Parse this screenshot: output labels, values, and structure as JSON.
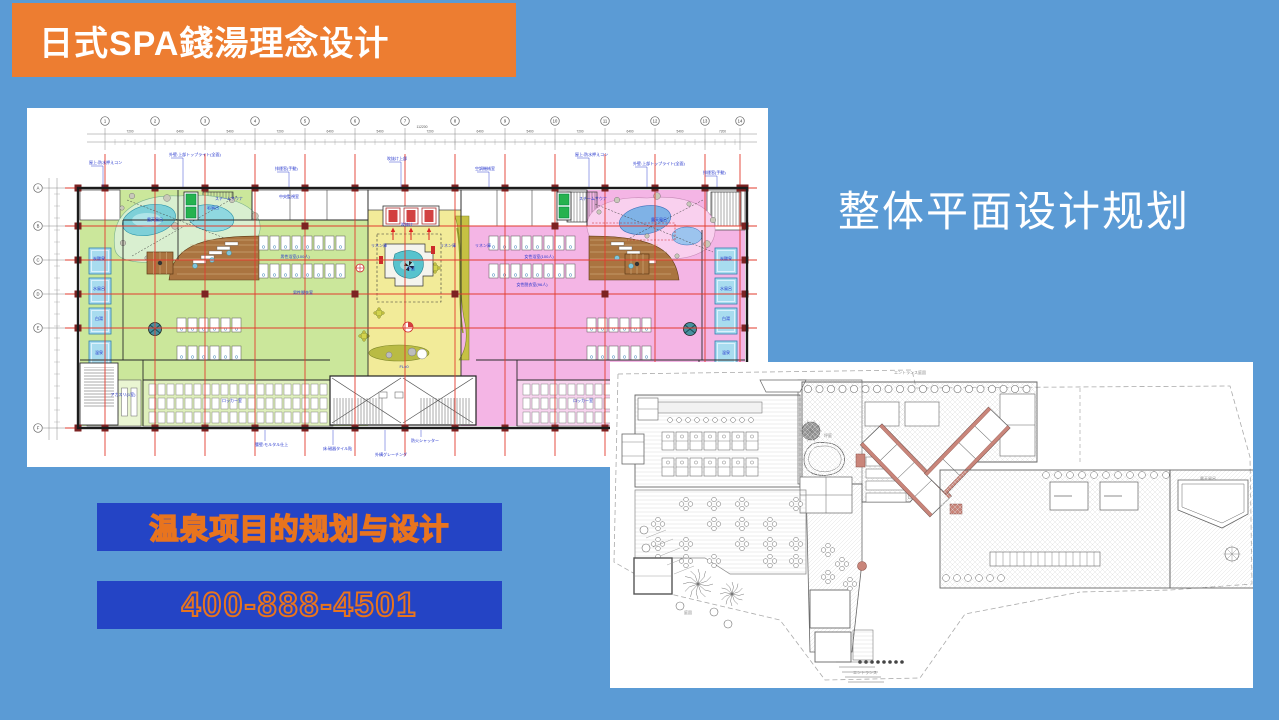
{
  "slide": {
    "background_color": "#5b9bd5"
  },
  "header": {
    "title": "日式SPA錢湯理念设计",
    "bg_color": "#ed7d31",
    "text_color": "#ffffff"
  },
  "section_title": {
    "text": "整体平面设计规划",
    "color": "#ffffff"
  },
  "contact_banners": {
    "bg_color": "#2444c5",
    "outline_color": "#e8741e",
    "project_label": "温泉项目的规划与设计",
    "project_fill_color": "#1c2a6e",
    "phone": "400-888-4501",
    "phone_fill_color": "#2444c5"
  },
  "plan_main": {
    "description": "colored onsen floor plan drawing",
    "colors": {
      "zone_green": "#cbe79b",
      "zone_yellow": "#f2eb99",
      "zone_pink": "#f4b5e5",
      "pond_left_bg": "#d9efd0",
      "pond_left_water": "#7ed0d8",
      "pond_right_bg": "#f9d0ee",
      "pond_right_water": "#7fb2e6",
      "pool_blue": "#a8dcef",
      "deck_brown": "#aa7440",
      "olive": "#c6c143",
      "grid_red": "#e23b2e",
      "column_red": "#7c2222",
      "wall": "#1b1b1b",
      "note_blue": "#2233cc",
      "elevator_green": "#26b24e",
      "elevator_red": "#d24040"
    },
    "grid_bubbles_top": [
      "1",
      "2",
      "3",
      "4",
      "5",
      "6",
      "7",
      "8",
      "9",
      "10",
      "11",
      "12",
      "13",
      "14"
    ],
    "grid_bubbles_left": [
      "A",
      "B",
      "C",
      "D",
      "E",
      "F"
    ],
    "dim_labels_top": [
      "7200",
      "6400",
      "5400",
      "7200",
      "6400",
      "5400",
      "7200",
      "6400",
      "5400",
      "7200",
      "6400",
      "5400",
      "7200"
    ],
    "total_dim_label": "112200",
    "labels": [
      {
        "t": "露天風呂",
        "x": 128,
        "y": 113
      },
      {
        "t": "岩風呂",
        "x": 186,
        "y": 101
      },
      {
        "t": "スチームサウナ",
        "x": 202,
        "y": 92
      },
      {
        "t": "中央監視室",
        "x": 262,
        "y": 90
      },
      {
        "t": "リネン庫",
        "x": 352,
        "y": 139
      },
      {
        "t": "リネン庫",
        "x": 421,
        "y": 139
      },
      {
        "t": "リネン庫",
        "x": 456,
        "y": 139
      },
      {
        "t": "吹抜け",
        "x": 380,
        "y": 118
      },
      {
        "t": "坪庭",
        "x": 384,
        "y": 162
      },
      {
        "t": "FL±0",
        "x": 377,
        "y": 260
      },
      {
        "t": "男性浴室(100人)",
        "x": 268,
        "y": 150
      },
      {
        "t": "男性脱衣室",
        "x": 276,
        "y": 186
      },
      {
        "t": "女性浴室(100人)",
        "x": 512,
        "y": 150
      },
      {
        "t": "女性脱衣室(96人)",
        "x": 505,
        "y": 178
      },
      {
        "t": "炭酸泉",
        "x": 72,
        "y": 152
      },
      {
        "t": "水風呂",
        "x": 72,
        "y": 182
      },
      {
        "t": "白湯",
        "x": 72,
        "y": 212
      },
      {
        "t": "温泉",
        "x": 72,
        "y": 246
      },
      {
        "t": "炭酸泉",
        "x": 699,
        "y": 152
      },
      {
        "t": "水風呂",
        "x": 699,
        "y": 182
      },
      {
        "t": "白湯",
        "x": 699,
        "y": 212
      },
      {
        "t": "温泉",
        "x": 699,
        "y": 246
      },
      {
        "t": "スチームサウナ",
        "x": 566,
        "y": 92
      },
      {
        "t": "露天風呂",
        "x": 632,
        "y": 113
      },
      {
        "t": "ロッカー室",
        "x": 205,
        "y": 294
      },
      {
        "t": "ロッカー室",
        "x": 556,
        "y": 294
      },
      {
        "t": "アカスリ(1室)",
        "x": 96,
        "y": 288
      }
    ],
    "top_annotations": [
      {
        "t": "屋上:防水押えコン",
        "x": 62,
        "y": 56
      },
      {
        "t": "外壁:上部トップライト(全面)",
        "x": 142,
        "y": 48
      },
      {
        "t": "排煙窓(手動)",
        "x": 248,
        "y": 62
      },
      {
        "t": "吹抜け上部",
        "x": 360,
        "y": 52
      },
      {
        "t": "空調機械室",
        "x": 448,
        "y": 62
      },
      {
        "t": "屋上:防水押えコン",
        "x": 548,
        "y": 48
      },
      {
        "t": "外壁:上部トップライト(全面)",
        "x": 606,
        "y": 57
      },
      {
        "t": "排煙窓(手動)",
        "x": 676,
        "y": 66
      }
    ],
    "bottom_annotations": [
      {
        "t": "腰壁:モルタル仕上",
        "x": 228,
        "y": 338
      },
      {
        "t": "床:磁器タイル貼",
        "x": 296,
        "y": 342
      },
      {
        "t": "外構グレーチング",
        "x": 348,
        "y": 348
      },
      {
        "t": "防火シャッター",
        "x": 384,
        "y": 334
      },
      {
        "t": "サッシ:複層ガラス",
        "x": 590,
        "y": 338
      }
    ]
  },
  "plan_site": {
    "description": "grayscale site / ground floor line plan",
    "colors": {
      "line": "#666666",
      "hatch": "#d6d6d6",
      "accent_salmon": "#c9857a",
      "boundary": "#aaaaaa"
    },
    "labels": [
      {
        "t": "エントランス庭園",
        "x": 300,
        "y": 12
      },
      {
        "t": "坪庭",
        "x": 218,
        "y": 75
      },
      {
        "t": "露天風呂",
        "x": 598,
        "y": 118
      },
      {
        "t": "庭園",
        "x": 78,
        "y": 252
      },
      {
        "t": "エントランス",
        "x": 255,
        "y": 312
      }
    ]
  }
}
